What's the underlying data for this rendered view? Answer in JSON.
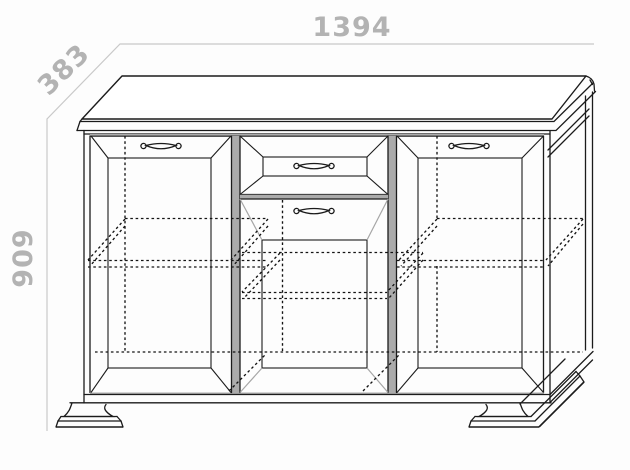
{
  "title": "Sideboard technical drawing",
  "dimensions": {
    "width": {
      "label": "1394",
      "orientation": "horizontal-top"
    },
    "depth": {
      "label": "383",
      "orientation": "diagonal-top-left"
    },
    "height": {
      "label": "909",
      "orientation": "vertical-left"
    }
  },
  "colors": {
    "bg": "#fdfdfd",
    "line": "#1b1b1b",
    "dimline": "#c9c9c9",
    "dimtext": "#b3b3b3",
    "gap": "#ababab",
    "bevel": "#a6a6a6",
    "dash": "#141414"
  }
}
